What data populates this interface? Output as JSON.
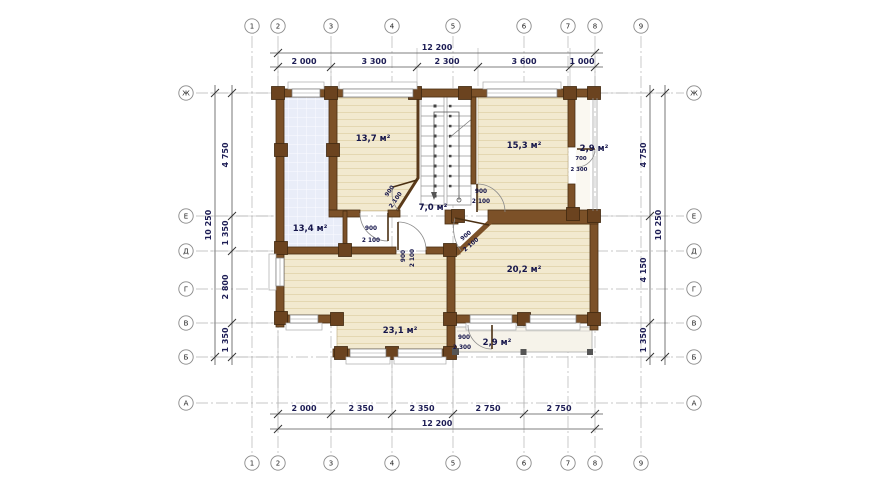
{
  "drawing": "second-floor plan of a log house",
  "axes": {
    "top": [
      "1",
      "2",
      "3",
      "4",
      "5",
      "6",
      "7",
      "8",
      "9"
    ],
    "bottom": [
      "1",
      "2",
      "3",
      "4",
      "5",
      "6",
      "7",
      "8",
      "9"
    ],
    "left": [
      "Ж",
      "Е",
      "Д",
      "Г",
      "В",
      "Б",
      "А"
    ],
    "right": [
      "Ж",
      "Е",
      "Д",
      "Г",
      "В",
      "Б",
      "А"
    ]
  },
  "dims": {
    "top_total": "12 200",
    "top_seg": [
      "2 000",
      "3 300",
      "2 300",
      "3 600",
      "1 000"
    ],
    "bot_seg": [
      "2 000",
      "2 350",
      "2 350",
      "2 750",
      "2 750"
    ],
    "bot_total": "12 200",
    "left_total": "10 250",
    "left_seg": [
      "4 750",
      "1 350",
      "2 800",
      "1 350"
    ],
    "right_seg": [
      "4 750",
      "4 150",
      "1 350"
    ],
    "right_total": "10 250"
  },
  "rooms": {
    "r13_7": "13,7 м²",
    "r15_3": "15,3 м²",
    "r2_9r": "2,9 м²",
    "r13_4": "13,4 м²",
    "r7_0": "7,0 м²",
    "r20_2": "20,2 м²",
    "r23_1": "23,1 м²",
    "r2_9b": "2,9 м²"
  },
  "doors": {
    "d1": {
      "w": "900",
      "h": "2 100"
    },
    "d2": {
      "w": "900",
      "h": "2 100"
    },
    "d3": {
      "w": "700",
      "h": "2 300"
    },
    "d4": {
      "w": "900",
      "h": "2 100"
    },
    "d5": {
      "w": "900",
      "h": "2 100"
    },
    "d6": {
      "w": "900",
      "h": "2 100"
    },
    "d7": {
      "w": "900",
      "h": "2 300"
    }
  },
  "colors": {
    "wall_brown": "#7c5128",
    "floor_beige": "#f2e9cf",
    "terrace_blue": "#e9edf8",
    "dim_text_navy": "#1d1d55"
  }
}
